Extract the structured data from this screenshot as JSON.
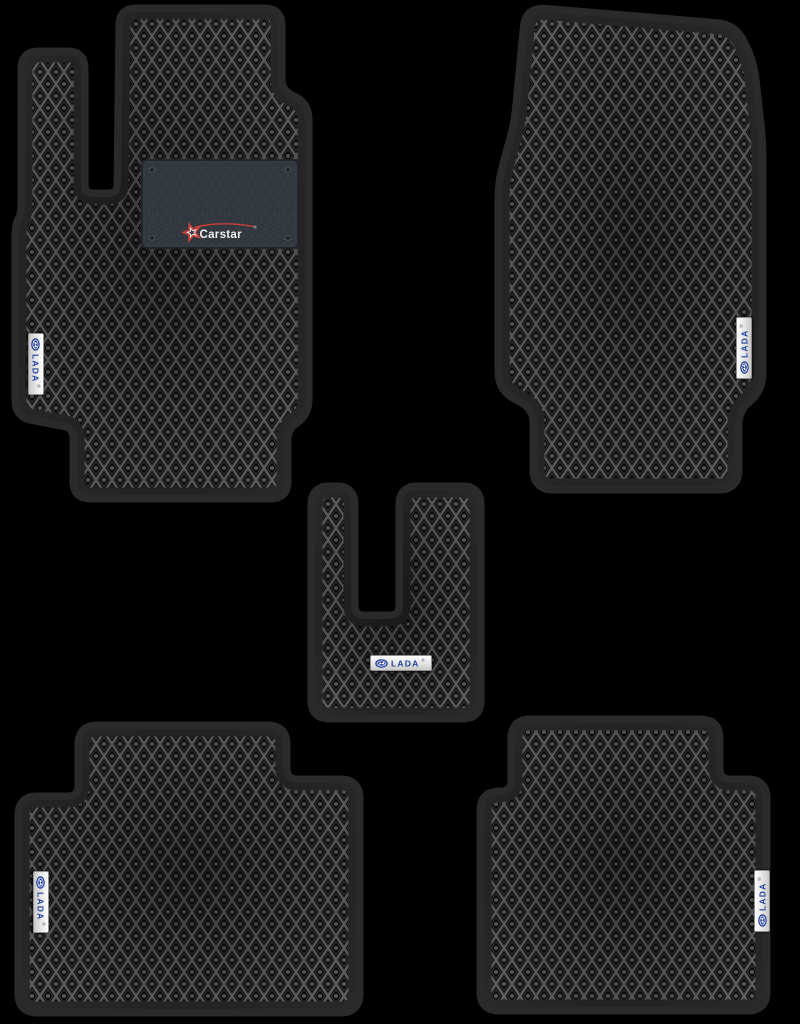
{
  "scene": {
    "background_color": "#000000",
    "product": "Set of 5 black EVA car floor mats with rhombus cell pattern and black edge trim"
  },
  "branding": {
    "heel_pad_brand": "Carstar",
    "heel_pad_registered_mark": "®",
    "badge_text": "LADA",
    "badge_registered_mark": "®"
  },
  "colors": {
    "mat_cell_background": "#0a0a0a",
    "mat_cell_lines": "#646464",
    "mat_border_trim": "#2a2a2a",
    "heel_pad": "#353b42",
    "badge_background": "#f2f2f2",
    "badge_blue": "#1f3b96",
    "carstar_red": "#cd4038",
    "carstar_text": "#f2f2f2"
  },
  "mats": [
    {
      "name": "Driver front mat",
      "position": "top-left",
      "badge_text": "LADA",
      "badge_orientation": "vertical-left-edge",
      "has_heel_pad": true,
      "heel_pad_brand": "Carstar"
    },
    {
      "name": "Front passenger mat",
      "position": "top-right",
      "badge_text": "LADA",
      "badge_orientation": "vertical-right-edge",
      "has_heel_pad": false
    },
    {
      "name": "Center tunnel mat",
      "position": "middle",
      "badge_text": "LADA",
      "badge_orientation": "horizontal",
      "has_heel_pad": false
    },
    {
      "name": "Rear left mat",
      "position": "bottom-left",
      "badge_text": "LADA",
      "badge_orientation": "vertical-left-edge",
      "has_heel_pad": false
    },
    {
      "name": "Rear right mat",
      "position": "bottom-right",
      "badge_text": "LADA",
      "badge_orientation": "vertical-right-edge",
      "has_heel_pad": false
    }
  ]
}
